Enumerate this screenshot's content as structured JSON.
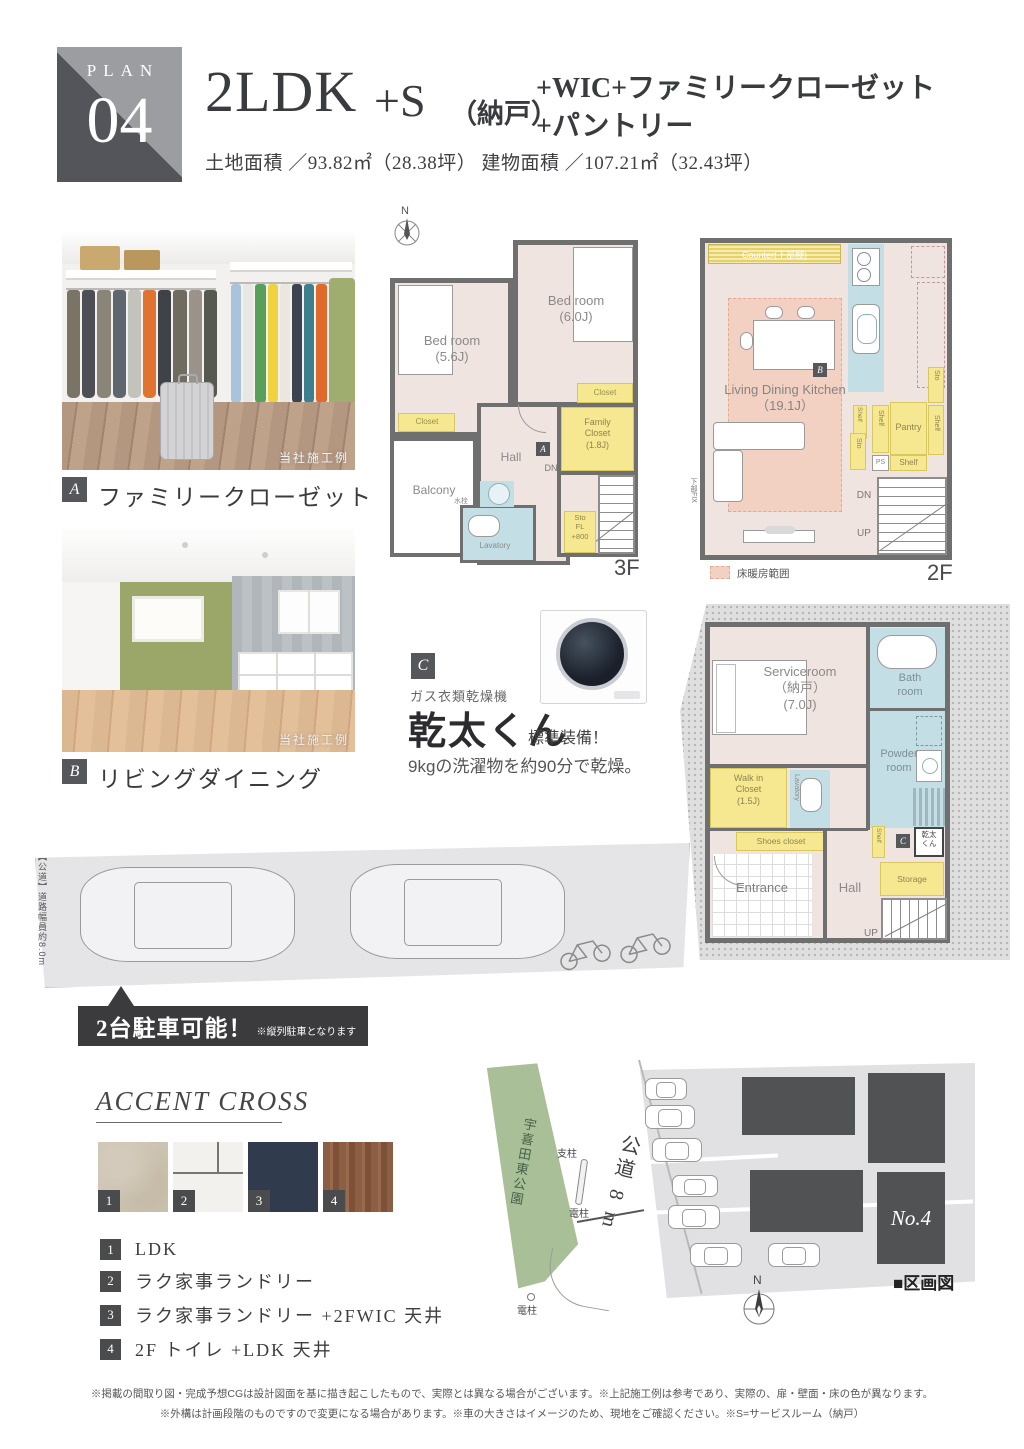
{
  "header": {
    "plan_label": "PLAN",
    "plan_number": "04",
    "title_main": "2LDK",
    "title_plus_s": "+S",
    "title_paren": "（納戸）",
    "title_sub1": "+WIC+ファミリークローゼット",
    "title_sub2": "+パントリー",
    "area_line": "土地面積 ／93.82㎡（28.38坪） 建物面積 ／107.21㎡（32.43坪）"
  },
  "photo_a": {
    "badge": "A",
    "caption": "ファミリークローゼット",
    "watermark": "当社施工例"
  },
  "photo_b": {
    "badge": "B",
    "caption": "リビングダイニング",
    "watermark": "当社施工例"
  },
  "plan3f": {
    "compass_n": "N",
    "bedroom1": "Bed room\n(5.6J)",
    "bedroom2": "Bed room\n(6.0J)",
    "closet1": "Closet",
    "closet2": "Closet",
    "family_closet": "Family\nCloset\n(1.8J)",
    "hall": "Hall",
    "badge_a": "A",
    "balcony": "Balcony",
    "faucet": "水栓",
    "lavatory": "Lavatory",
    "dn": "DN",
    "sto": "Sto\nFL\n+800",
    "floor_label": "3F"
  },
  "plan2f": {
    "counter": "Counter(下部棚)",
    "ldk": "Living Dining Kitchen\n（19.1J）",
    "badge_b": "B",
    "sto_right": "Sto",
    "shelf1": "Shelf",
    "shelf2": "Shelf",
    "pantry": "Pantry",
    "shelf3": "Shelf",
    "sto_left": "Sto",
    "ps": "PS",
    "shelf4": "Shelf",
    "dn": "DN",
    "up": "UP",
    "fix": "下部FIX",
    "legend": "床暖房範囲",
    "floor_label": "2F"
  },
  "plan1f": {
    "serviceroom": "Serviceroom\n（納戸）\n(7.0J)",
    "bathroom": "Bath\nroom",
    "powder": "Powder\nroom",
    "wic": "Walk in\nCloset\n(1.5J)",
    "lavatory": "Lavatory",
    "shoes": "Shoes closet",
    "entrance": "Entrance",
    "hall": "Hall",
    "shelf": "Shelf",
    "badge_c": "C",
    "kanta": "乾太\nくん",
    "storage": "Storage",
    "up": "UP"
  },
  "dryer": {
    "badge_c": "C",
    "subtitle": "ガス衣類乾燥機",
    "name": "乾太くん",
    "standard": "標準装備！",
    "desc": "9kgの洗濯物を約90分で乾燥。"
  },
  "parking": {
    "road_label": "【公道】道路幅員約8.0m",
    "banner": "2台駐車可能！",
    "banner_note": "※縦列駐車となります"
  },
  "accent": {
    "title": "ACCENT CROSS",
    "items": [
      {
        "num": "1",
        "label": "LDK"
      },
      {
        "num": "2",
        "label": "ラク家事ランドリー"
      },
      {
        "num": "3",
        "label": "ラク家事ランドリー +2FWIC 天井"
      },
      {
        "num": "4",
        "label": "2F トイレ +LDK 天井"
      }
    ]
  },
  "siteplan": {
    "park": "宇喜田東公園",
    "road": "公道 8 m",
    "pole1": "支柱",
    "pole2": "電柱",
    "pole3": "電柱",
    "lot_no": "No.4",
    "legend": "■区画図",
    "compass_n": "N"
  },
  "footer": {
    "line1": "※掲載の間取り図・完成予想CGは設計図面を基に描き起こしたもので、実際とは異なる場合がございます。※上記施工例は参考であり、実際の、扉・壁面・床の色が異なります。",
    "line2": "※外構は計画段階のものですので変更になる場合があります。※車の大きさはイメージのため、現地をご確認ください。※S=サービスルーム（納戸）"
  },
  "colors": {
    "wall": "#6f6f6f",
    "floor_pink": "#f0e4e0",
    "closet_yellow": "#f6e890",
    "wet_blue": "#c3dfe5",
    "heating_pink": "#f3d1c2",
    "park_green": "#a9bf97",
    "banner_dark": "#3b3b3d",
    "badge_gray": "#55575b"
  }
}
